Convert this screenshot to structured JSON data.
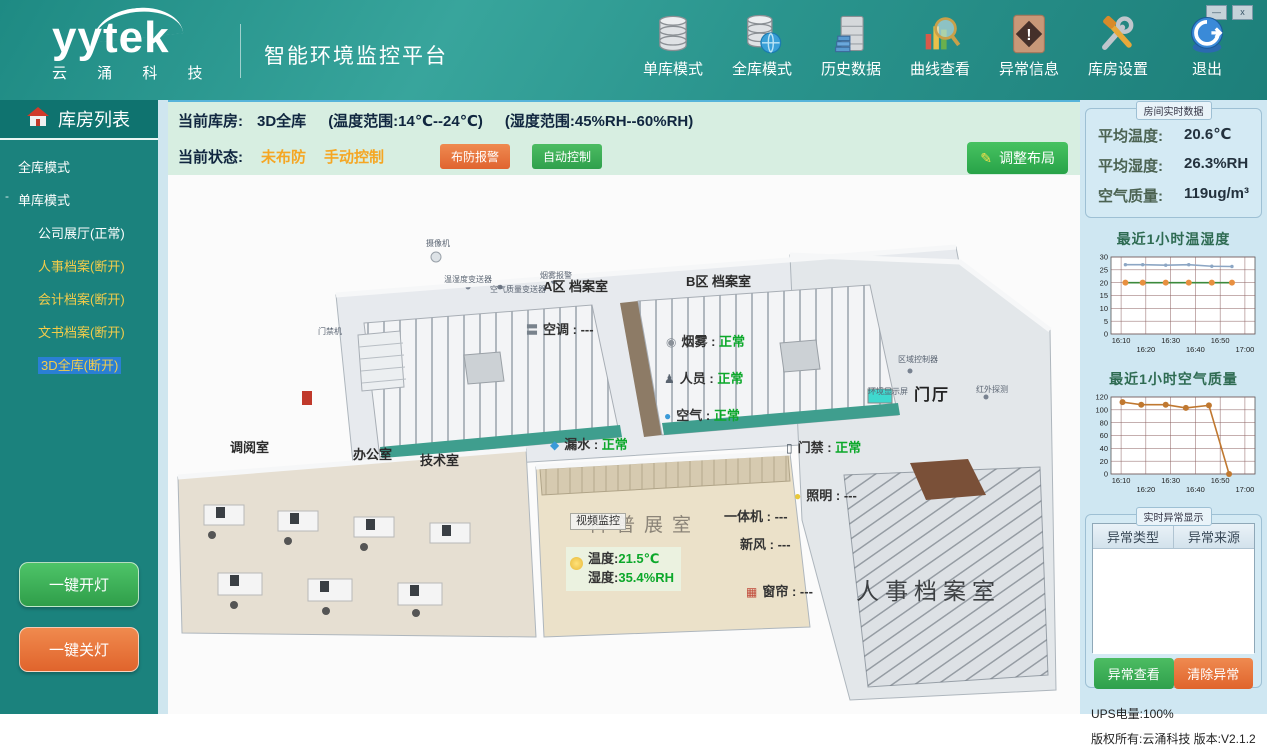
{
  "window_controls": {
    "minimize": "—",
    "close": "x"
  },
  "header": {
    "logo_text": "yytek",
    "logo_subtext": "云 涌 科 技",
    "title": "智能环境监控平台",
    "toolbar": [
      {
        "label": "单库模式",
        "icon": "single-database-icon"
      },
      {
        "label": "全库模式",
        "icon": "all-database-globe-icon"
      },
      {
        "label": "历史数据",
        "icon": "history-cabinet-icon"
      },
      {
        "label": "曲线查看",
        "icon": "curve-magnifier-icon"
      },
      {
        "label": "异常信息",
        "icon": "warning-diamond-icon"
      },
      {
        "label": "库房设置",
        "icon": "tools-icon"
      },
      {
        "label": "退出",
        "icon": "exit-icon"
      }
    ]
  },
  "sidebar": {
    "title": "库房列表",
    "tree": [
      {
        "label": "全库模式",
        "level": 0,
        "status": "normal"
      },
      {
        "label": "单库模式",
        "level": 0,
        "status": "normal",
        "expander": "-"
      },
      {
        "label": "公司展厅(正常)",
        "level": 1,
        "status": "normal"
      },
      {
        "label": "人事档案(断开)",
        "level": 1,
        "status": "disconnected"
      },
      {
        "label": "会计档案(断开)",
        "level": 1,
        "status": "disconnected"
      },
      {
        "label": "文书档案(断开)",
        "level": 1,
        "status": "disconnected",
        "selected": true
      },
      {
        "label": "3D全库(断开)",
        "level": 1,
        "status": "disconnected",
        "selected": true
      }
    ],
    "lights_on": "一键开灯",
    "lights_off": "一键关灯"
  },
  "statusbar": {
    "current_label": "当前库房:",
    "current_value": "3D全库",
    "temp_range": "(温度范围:14℃--24℃)",
    "hum_range": "(湿度范围:45%RH--60%RH)",
    "state_label": "当前状态:",
    "state_arm": "未布防",
    "state_mode": "手动控制",
    "arm_button": "布防报警",
    "auto_button": "自动控制",
    "layout_button": "调整布局",
    "layout_button_icon": "✎"
  },
  "scene": {
    "labels": [
      {
        "name": "area-a-label",
        "text": "A区 档案室",
        "x": 375,
        "y": 105,
        "type": "room"
      },
      {
        "name": "area-b-label",
        "text": "B区 档案室",
        "x": 518,
        "y": 100,
        "type": "room"
      },
      {
        "name": "hall-label",
        "text": "门厅",
        "x": 746,
        "y": 212,
        "type": "room-bold"
      },
      {
        "name": "reading-room-label",
        "text": "调阅室",
        "x": 62,
        "y": 266,
        "type": "room"
      },
      {
        "name": "office-label",
        "text": "办公室",
        "x": 185,
        "y": 273,
        "type": "room"
      },
      {
        "name": "tech-room-label",
        "text": "技术室",
        "x": 252,
        "y": 279,
        "type": "room"
      },
      {
        "name": "exhibit-room-floor-text",
        "text": "科普展室",
        "x": 420,
        "y": 340,
        "type": "floor-text"
      },
      {
        "name": "personnel-archive-label",
        "text": "人事档案室",
        "x": 688,
        "y": 404,
        "type": "big-room"
      },
      {
        "name": "video-monitor-chip",
        "text": "视频监控",
        "x": 402,
        "y": 338,
        "type": "chip"
      },
      {
        "name": "ac-sensor",
        "text": "空调",
        "value": "---",
        "x": 358,
        "y": 148,
        "type": "sensor",
        "icon": "〓",
        "icon_color": "#78828c"
      },
      {
        "name": "smoke-sensor",
        "text": "烟雾",
        "value": "正常",
        "x": 498,
        "y": 160,
        "type": "sensor",
        "icon": "◉",
        "icon_color": "#8a9098"
      },
      {
        "name": "person-sensor",
        "text": "人员",
        "value": "正常",
        "x": 496,
        "y": 197,
        "type": "sensor",
        "icon": "♟",
        "icon_color": "#5a6470"
      },
      {
        "name": "air-sensor",
        "text": "空气",
        "value": "正常",
        "x": 496,
        "y": 234,
        "type": "sensor",
        "icon": "●",
        "icon_color": "#3a9ad8"
      },
      {
        "name": "leak-sensor",
        "text": "漏水",
        "value": "正常",
        "x": 382,
        "y": 263,
        "type": "sensor",
        "icon": "◆",
        "icon_color": "#3a9ad8"
      },
      {
        "name": "door-sensor",
        "text": "门禁",
        "value": "正常",
        "x": 618,
        "y": 266,
        "type": "sensor",
        "icon": "▯",
        "icon_color": "#4a5560"
      },
      {
        "name": "light-sensor",
        "text": "照明",
        "value": "---",
        "x": 626,
        "y": 314,
        "type": "sensor",
        "icon": "●",
        "icon_color": "#e8c83a"
      },
      {
        "name": "allinone-sensor",
        "text": "一体机",
        "value": "---",
        "x": 556,
        "y": 335,
        "type": "sensor"
      },
      {
        "name": "freshair-sensor",
        "text": "新风",
        "value": "---",
        "x": 572,
        "y": 363,
        "type": "sensor"
      },
      {
        "name": "curtain-sensor",
        "text": "窗帘",
        "value": "---",
        "x": 578,
        "y": 410,
        "type": "sensor",
        "icon": "▦",
        "icon_color": "#c04a3a"
      },
      {
        "name": "camera-device-label",
        "text": "摄像机",
        "x": 258,
        "y": 64,
        "type": "device"
      },
      {
        "name": "temphum-device-label",
        "text": "温湿度变送器",
        "x": 276,
        "y": 100,
        "type": "device"
      },
      {
        "name": "airquality-device-label",
        "text": "空气质量变送器",
        "x": 322,
        "y": 110,
        "type": "device"
      },
      {
        "name": "smokealarm-device-label",
        "text": "烟雾报警",
        "x": 372,
        "y": 96,
        "type": "device"
      },
      {
        "name": "zonecontroller-device-label",
        "text": "区域控制器",
        "x": 730,
        "y": 180,
        "type": "device"
      },
      {
        "name": "envdisplay-device-label",
        "text": "环境显示屏",
        "x": 700,
        "y": 212,
        "type": "device"
      },
      {
        "name": "infrared-device-label",
        "text": "红外探测",
        "x": 808,
        "y": 210,
        "type": "device"
      },
      {
        "name": "doorunit-device-label",
        "text": "门禁机",
        "x": 150,
        "y": 152,
        "type": "device"
      }
    ],
    "temp_badge": {
      "line1_label": "温度:",
      "line1_value": "21.5℃",
      "line2_label": "湿度:",
      "line2_value": "35.4%RH"
    }
  },
  "right_panel": {
    "realtime": {
      "title": "房间实时数据",
      "rows": [
        {
          "label": "平均温度:",
          "value": "20.6℃"
        },
        {
          "label": "平均湿度:",
          "value": "26.3%RH"
        },
        {
          "label": "空气质量:",
          "value": "119ug/m³"
        }
      ]
    },
    "alerts": {
      "title": "实时异常显示",
      "columns": [
        "异常类型",
        "异常来源"
      ],
      "rows": [],
      "view_button": "异常查看",
      "clear_button": "清除异常"
    },
    "footer": {
      "ups": "UPS电量:100%",
      "copyright": "版权所有:云涌科技  版本:V2.1.2"
    }
  },
  "chart_data": [
    {
      "type": "line",
      "title": "最近1小时温湿度",
      "x_ticks": [
        "16:10",
        "16:20",
        "16:30",
        "16:40",
        "16:50",
        "17:00"
      ],
      "ylim": [
        0,
        30
      ],
      "y_ticks": [
        0,
        5,
        10,
        15,
        20,
        25,
        30
      ],
      "grid": true,
      "series": [
        {
          "name": "湿度",
          "color": "#8ca6c4",
          "marker": "tick",
          "marker_color": "#8ca6c4",
          "x": [
            0.1,
            0.22,
            0.38,
            0.54,
            0.7,
            0.84
          ],
          "values": [
            27,
            27,
            26.8,
            27,
            26.4,
            26.3
          ]
        },
        {
          "name": "温度",
          "color": "#3c8a3c",
          "marker": "circle",
          "marker_color": "#e89040",
          "x": [
            0.1,
            0.22,
            0.38,
            0.54,
            0.7,
            0.84
          ],
          "values": [
            20,
            20,
            20,
            20,
            20,
            20
          ]
        }
      ]
    },
    {
      "type": "line",
      "title": "最近1小时空气质量",
      "x_ticks": [
        "16:10",
        "16:20",
        "16:30",
        "16:40",
        "16:50",
        "17:00"
      ],
      "ylim": [
        0,
        120
      ],
      "y_ticks": [
        0,
        20,
        40,
        60,
        80,
        100,
        120
      ],
      "grid": true,
      "series": [
        {
          "name": "空气质量",
          "color": "#c07830",
          "marker": "circle",
          "marker_color": "#c07830",
          "x": [
            0.08,
            0.21,
            0.38,
            0.52,
            0.68,
            0.82
          ],
          "values": [
            112,
            108,
            108,
            103,
            107,
            0
          ]
        }
      ]
    }
  ]
}
